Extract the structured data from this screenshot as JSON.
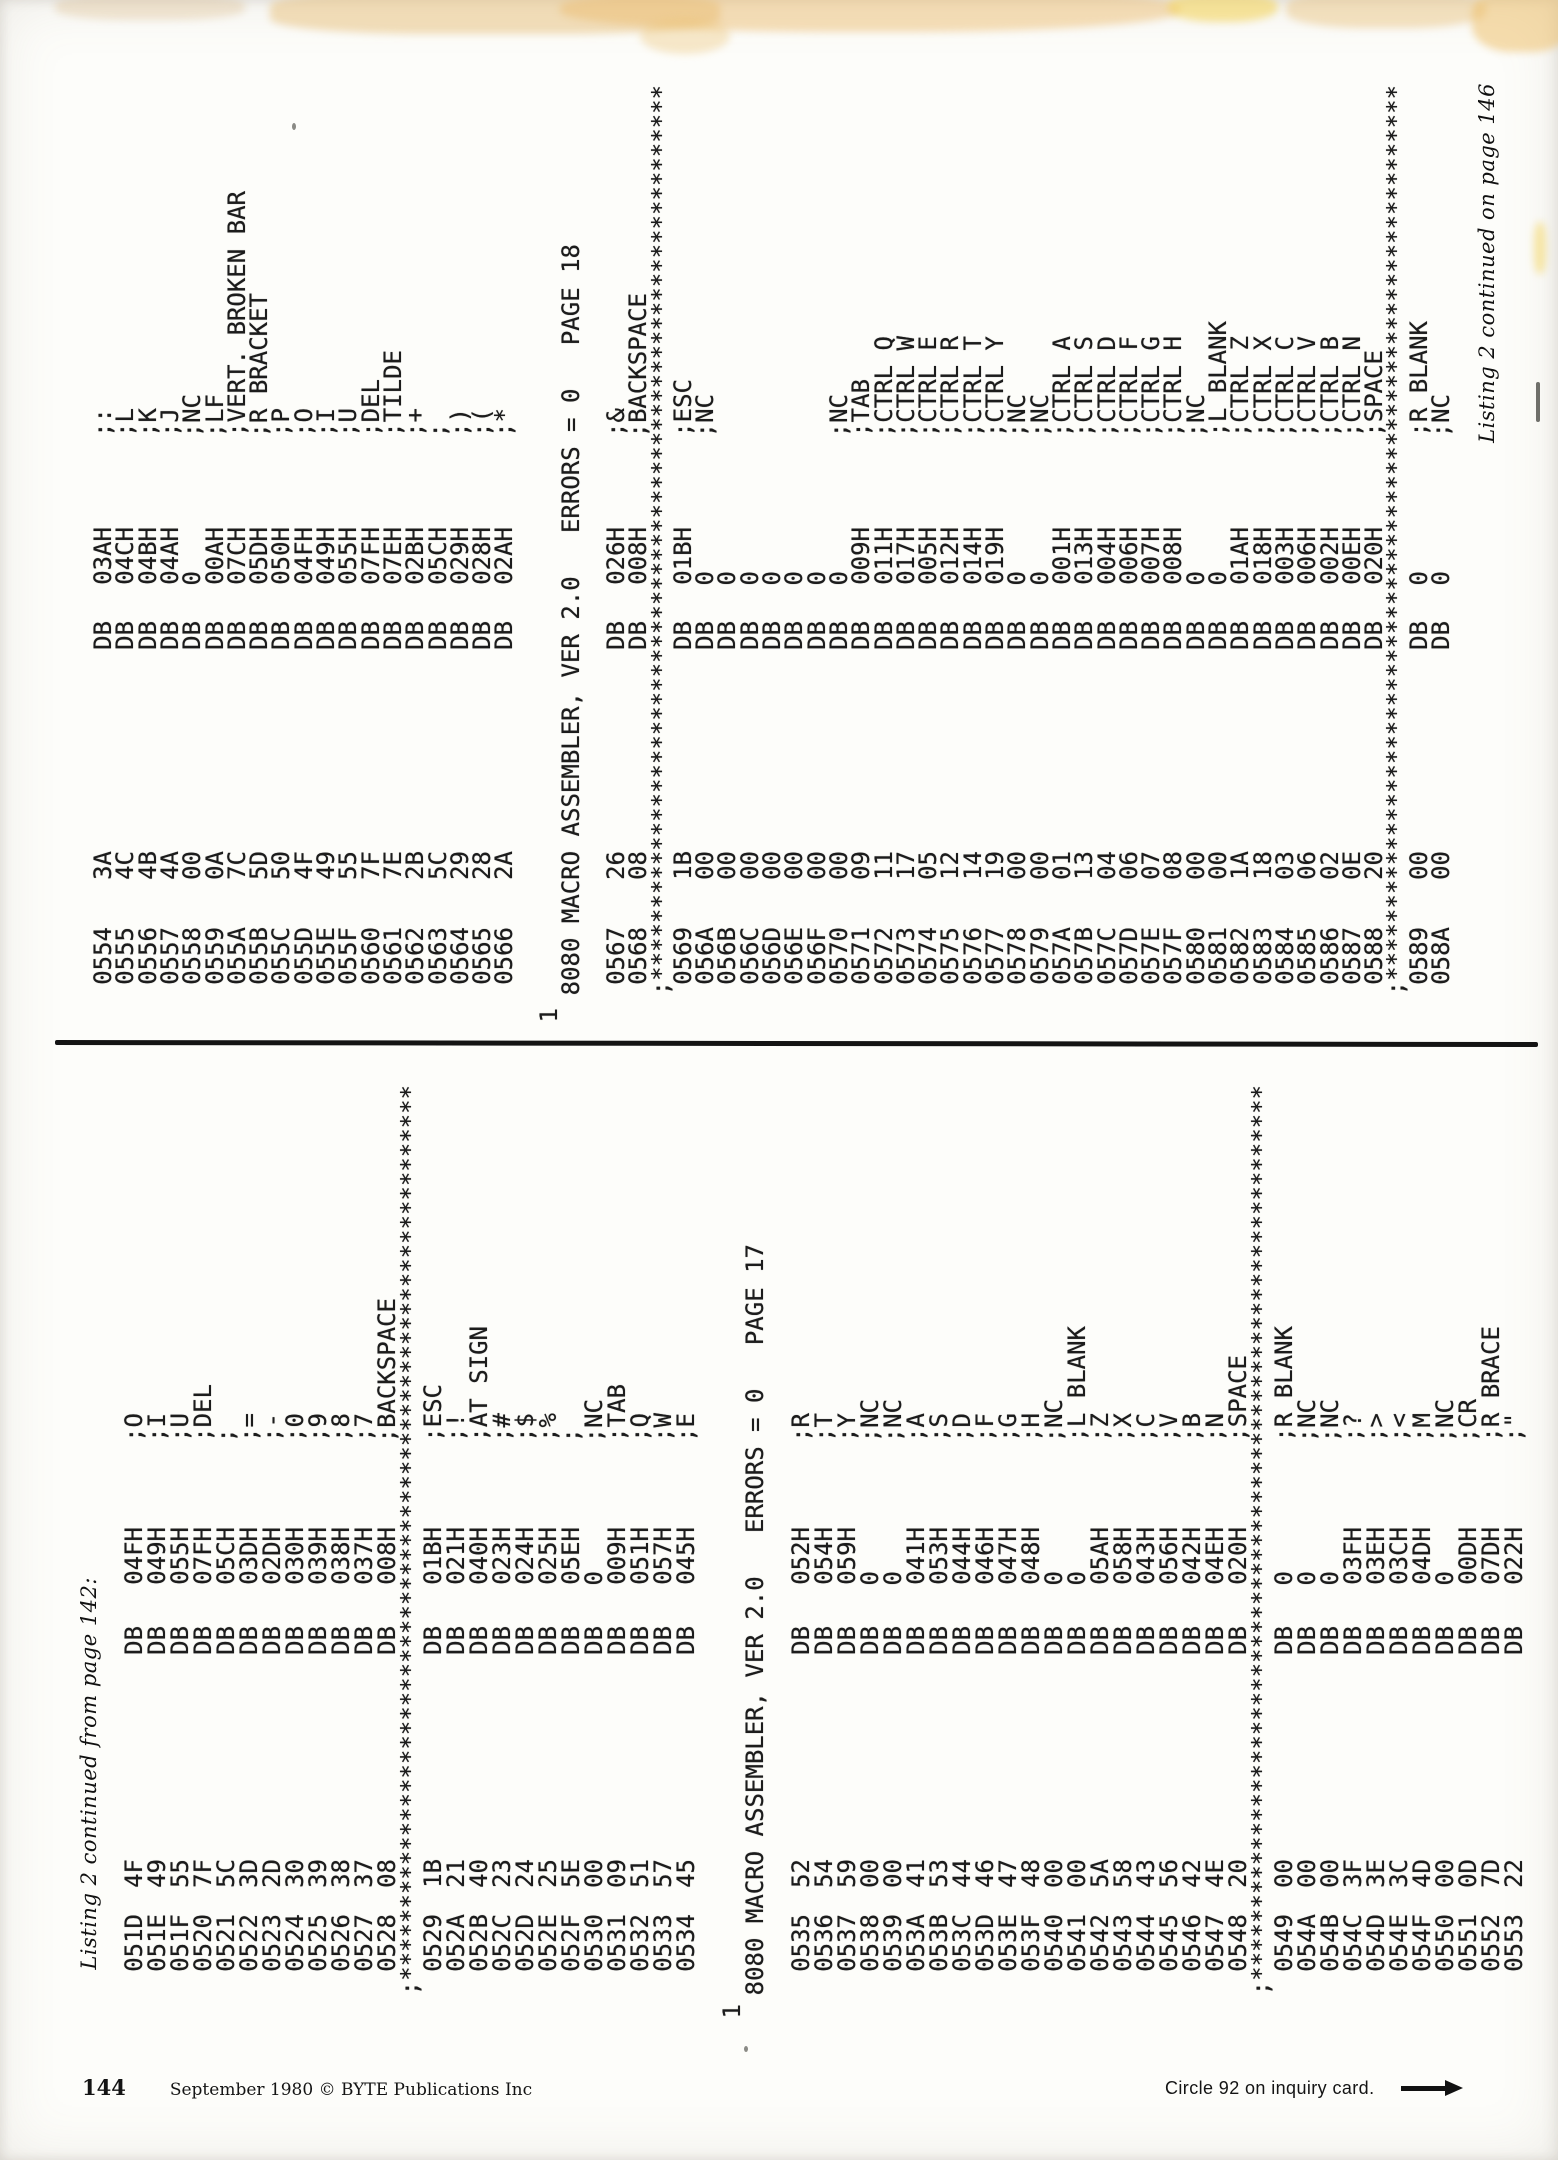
{
  "document": {
    "type": "magazine-listing-scan",
    "publication": "BYTE Publications Inc",
    "colors": {
      "paper": "#fdfdfa",
      "ink": "#1c1c1c",
      "smudge_tan": "#e8c07a",
      "smudge_yellow": "#f4d45e"
    }
  },
  "footer": {
    "page_number": "144",
    "imprint": "September 1980 © BYTE Publications Inc",
    "circle_note": "Circle 92 on inquiry card.",
    "arrow_icon": "right-arrow"
  },
  "stars_line": ";**************************************************************",
  "bands": [
    {
      "id": "p17",
      "caption": "Listing 2 continued from page 142:",
      "caption_position": "line-start",
      "form_feed_marker": "1",
      "header": "8080 MACRO ASSEMBLER, VER 2.0   ERRORS = 0   PAGE 17",
      "opcode": "DB",
      "columns": [
        {
          "t": "caption"
        },
        {
          "t": "gap"
        },
        {
          "t": "line",
          "a": "051D",
          "b": "4F",
          "o": "04FH",
          "c": ";O"
        },
        {
          "t": "line",
          "a": "051E",
          "b": "49",
          "o": "049H",
          "c": ";I"
        },
        {
          "t": "line",
          "a": "051F",
          "b": "55",
          "o": "055H",
          "c": ";U"
        },
        {
          "t": "line",
          "a": "0520",
          "b": "7F",
          "o": "07FH",
          "c": ";DEL"
        },
        {
          "t": "line",
          "a": "0521",
          "b": "5C",
          "o": "05CH",
          "c": ";"
        },
        {
          "t": "line",
          "a": "0522",
          "b": "3D",
          "o": "03DH",
          "c": ";="
        },
        {
          "t": "line",
          "a": "0523",
          "b": "2D",
          "o": "02DH",
          "c": ";-"
        },
        {
          "t": "line",
          "a": "0524",
          "b": "30",
          "o": "030H",
          "c": ";0"
        },
        {
          "t": "line",
          "a": "0525",
          "b": "39",
          "o": "039H",
          "c": ";9"
        },
        {
          "t": "line",
          "a": "0526",
          "b": "38",
          "o": "038H",
          "c": ";8"
        },
        {
          "t": "line",
          "a": "0527",
          "b": "37",
          "o": "037H",
          "c": ";7"
        },
        {
          "t": "line",
          "a": "0528",
          "b": "08",
          "o": "008H",
          "c": ";BACKSPACE"
        },
        {
          "t": "stars"
        },
        {
          "t": "line",
          "a": "0529",
          "b": "1B",
          "o": "01BH",
          "c": ";ESC"
        },
        {
          "t": "line",
          "a": "052A",
          "b": "21",
          "o": "021H",
          "c": ";!"
        },
        {
          "t": "line",
          "a": "052B",
          "b": "40",
          "o": "040H",
          "c": ";AT SIGN"
        },
        {
          "t": "line",
          "a": "052C",
          "b": "23",
          "o": "023H",
          "c": ";#"
        },
        {
          "t": "line",
          "a": "052D",
          "b": "24",
          "o": "024H",
          "c": ";$"
        },
        {
          "t": "line",
          "a": "052E",
          "b": "25",
          "o": "025H",
          "c": ";%"
        },
        {
          "t": "line",
          "a": "052F",
          "b": "5E",
          "o": "05EH",
          "c": ";"
        },
        {
          "t": "line",
          "a": "0530",
          "b": "00",
          "o": "0",
          "c": ";NC"
        },
        {
          "t": "line",
          "a": "0531",
          "b": "09",
          "o": "009H",
          "c": ";TAB"
        },
        {
          "t": "line",
          "a": "0532",
          "b": "51",
          "o": "051H",
          "c": ";Q"
        },
        {
          "t": "line",
          "a": "0533",
          "b": "57",
          "o": "057H",
          "c": ";W"
        },
        {
          "t": "line",
          "a": "0534",
          "b": "45",
          "o": "045H",
          "c": ";E"
        },
        {
          "t": "gap"
        },
        {
          "t": "ff"
        },
        {
          "t": "header"
        },
        {
          "t": "gap"
        },
        {
          "t": "line",
          "a": "0535",
          "b": "52",
          "o": "052H",
          "c": ";R"
        },
        {
          "t": "line",
          "a": "0536",
          "b": "54",
          "o": "054H",
          "c": ";T"
        },
        {
          "t": "line",
          "a": "0537",
          "b": "59",
          "o": "059H",
          "c": ";Y"
        },
        {
          "t": "line",
          "a": "0538",
          "b": "00",
          "o": "0",
          "c": ";NC"
        },
        {
          "t": "line",
          "a": "0539",
          "b": "00",
          "o": "0",
          "c": ";NC"
        },
        {
          "t": "line",
          "a": "053A",
          "b": "41",
          "o": "041H",
          "c": ";A"
        },
        {
          "t": "line",
          "a": "053B",
          "b": "53",
          "o": "053H",
          "c": ";S"
        },
        {
          "t": "line",
          "a": "053C",
          "b": "44",
          "o": "044H",
          "c": ";D"
        },
        {
          "t": "line",
          "a": "053D",
          "b": "46",
          "o": "046H",
          "c": ";F"
        },
        {
          "t": "line",
          "a": "053E",
          "b": "47",
          "o": "047H",
          "c": ";G"
        },
        {
          "t": "line",
          "a": "053F",
          "b": "48",
          "o": "048H",
          "c": ";H"
        },
        {
          "t": "line",
          "a": "0540",
          "b": "00",
          "o": "0",
          "c": ";NC"
        },
        {
          "t": "line",
          "a": "0541",
          "b": "00",
          "o": "0",
          "c": ";L BLANK"
        },
        {
          "t": "line",
          "a": "0542",
          "b": "5A",
          "o": "05AH",
          "c": ";Z"
        },
        {
          "t": "line",
          "a": "0543",
          "b": "58",
          "o": "058H",
          "c": ";X"
        },
        {
          "t": "line",
          "a": "0544",
          "b": "43",
          "o": "043H",
          "c": ";C"
        },
        {
          "t": "line",
          "a": "0545",
          "b": "56",
          "o": "056H",
          "c": ";V"
        },
        {
          "t": "line",
          "a": "0546",
          "b": "42",
          "o": "042H",
          "c": ";B"
        },
        {
          "t": "line",
          "a": "0547",
          "b": "4E",
          "o": "04EH",
          "c": ";N"
        },
        {
          "t": "line",
          "a": "0548",
          "b": "20",
          "o": "020H",
          "c": ";SPACE"
        },
        {
          "t": "stars"
        },
        {
          "t": "line",
          "a": "0549",
          "b": "00",
          "o": "0",
          "c": ";R BLANK"
        },
        {
          "t": "line",
          "a": "054A",
          "b": "00",
          "o": "0",
          "c": ";NC"
        },
        {
          "t": "line",
          "a": "054B",
          "b": "00",
          "o": "0",
          "c": ";NC"
        },
        {
          "t": "line",
          "a": "054C",
          "b": "3F",
          "o": "03FH",
          "c": ";?"
        },
        {
          "t": "line",
          "a": "054D",
          "b": "3E",
          "o": "03EH",
          "c": ";>"
        },
        {
          "t": "line",
          "a": "054E",
          "b": "3C",
          "o": "03CH",
          "c": ";<"
        },
        {
          "t": "line",
          "a": "054F",
          "b": "4D",
          "o": "04DH",
          "c": ";M"
        },
        {
          "t": "line",
          "a": "0550",
          "b": "00",
          "o": "0",
          "c": ";NC"
        },
        {
          "t": "line",
          "a": "0551",
          "b": "0D",
          "o": "00DH",
          "c": ";CR"
        },
        {
          "t": "line",
          "a": "0552",
          "b": "7D",
          "o": "07DH",
          "c": ";R BRACE"
        },
        {
          "t": "line",
          "a": "0553",
          "b": "22",
          "o": "022H",
          "c": ";\""
        }
      ]
    },
    {
      "id": "p18",
      "caption": "Listing 2 continued on page 146",
      "caption_position": "line-end",
      "form_feed_marker": "1",
      "header": "8080 MACRO ASSEMBLER, VER 2.0   ERRORS = 0   PAGE 18",
      "opcode": "DB",
      "columns": [
        {
          "t": "line",
          "a": "0554",
          "b": "3A",
          "o": "03AH",
          "c": ";:"
        },
        {
          "t": "line",
          "a": "0555",
          "b": "4C",
          "o": "04CH",
          "c": ";L"
        },
        {
          "t": "line",
          "a": "0556",
          "b": "4B",
          "o": "04BH",
          "c": ";K"
        },
        {
          "t": "line",
          "a": "0557",
          "b": "4A",
          "o": "04AH",
          "c": ";J"
        },
        {
          "t": "line",
          "a": "0558",
          "b": "00",
          "o": "0",
          "c": ";NC"
        },
        {
          "t": "line",
          "a": "0559",
          "b": "0A",
          "o": "00AH",
          "c": ";LF"
        },
        {
          "t": "line",
          "a": "055A",
          "b": "7C",
          "o": "07CH",
          "c": ";VERT. BROKEN BAR"
        },
        {
          "t": "line",
          "a": "055B",
          "b": "5D",
          "o": "05DH",
          "c": ";R BRACKET"
        },
        {
          "t": "line",
          "a": "055C",
          "b": "50",
          "o": "050H",
          "c": ";P"
        },
        {
          "t": "line",
          "a": "055D",
          "b": "4F",
          "o": "04FH",
          "c": ";O"
        },
        {
          "t": "line",
          "a": "055E",
          "b": "49",
          "o": "049H",
          "c": ";I"
        },
        {
          "t": "line",
          "a": "055F",
          "b": "55",
          "o": "055H",
          "c": ";U"
        },
        {
          "t": "line",
          "a": "0560",
          "b": "7F",
          "o": "07FH",
          "c": ";DEL"
        },
        {
          "t": "line",
          "a": "0561",
          "b": "7E",
          "o": "07EH",
          "c": ";TILDE"
        },
        {
          "t": "line",
          "a": "0562",
          "b": "2B",
          "o": "02BH",
          "c": ";+"
        },
        {
          "t": "line",
          "a": "0563",
          "b": "5C",
          "o": "05CH",
          "c": ";"
        },
        {
          "t": "line",
          "a": "0564",
          "b": "29",
          "o": "029H",
          "c": ";)"
        },
        {
          "t": "line",
          "a": "0565",
          "b": "28",
          "o": "028H",
          "c": ";("
        },
        {
          "t": "line",
          "a": "0566",
          "b": "2A",
          "o": "02AH",
          "c": ";*"
        },
        {
          "t": "gap"
        },
        {
          "t": "ff"
        },
        {
          "t": "header"
        },
        {
          "t": "gap"
        },
        {
          "t": "line",
          "a": "0567",
          "b": "26",
          "o": "026H",
          "c": ";&"
        },
        {
          "t": "line",
          "a": "0568",
          "b": "08",
          "o": "008H",
          "c": ";BACKSPACE"
        },
        {
          "t": "stars"
        },
        {
          "t": "line",
          "a": "0569",
          "b": "1B",
          "o": "01BH",
          "c": ";ESC"
        },
        {
          "t": "line",
          "a": "056A",
          "b": "00",
          "o": "0",
          "c": ";NC"
        },
        {
          "t": "line",
          "a": "056B",
          "b": "00",
          "o": "0",
          "c": ""
        },
        {
          "t": "line",
          "a": "056C",
          "b": "00",
          "o": "0",
          "c": ""
        },
        {
          "t": "line",
          "a": "056D",
          "b": "00",
          "o": "0",
          "c": ""
        },
        {
          "t": "line",
          "a": "056E",
          "b": "00",
          "o": "0",
          "c": ""
        },
        {
          "t": "line",
          "a": "056F",
          "b": "00",
          "o": "0",
          "c": ""
        },
        {
          "t": "line",
          "a": "0570",
          "b": "00",
          "o": "0",
          "c": ";NC"
        },
        {
          "t": "line",
          "a": "0571",
          "b": "09",
          "o": "009H",
          "c": ";TAB"
        },
        {
          "t": "line",
          "a": "0572",
          "b": "11",
          "o": "011H",
          "c": ";CTRL Q"
        },
        {
          "t": "line",
          "a": "0573",
          "b": "17",
          "o": "017H",
          "c": ";CTRL W"
        },
        {
          "t": "line",
          "a": "0574",
          "b": "05",
          "o": "005H",
          "c": ";CTRL E"
        },
        {
          "t": "line",
          "a": "0575",
          "b": "12",
          "o": "012H",
          "c": ";CTRL R"
        },
        {
          "t": "line",
          "a": "0576",
          "b": "14",
          "o": "014H",
          "c": ";CTRL T"
        },
        {
          "t": "line",
          "a": "0577",
          "b": "19",
          "o": "019H",
          "c": ";CTRL Y"
        },
        {
          "t": "line",
          "a": "0578",
          "b": "00",
          "o": "0",
          "c": ";NC"
        },
        {
          "t": "line",
          "a": "0579",
          "b": "00",
          "o": "0",
          "c": ";NC"
        },
        {
          "t": "line",
          "a": "057A",
          "b": "01",
          "o": "001H",
          "c": ";CTRL A"
        },
        {
          "t": "line",
          "a": "057B",
          "b": "13",
          "o": "013H",
          "c": ";CTRL S"
        },
        {
          "t": "line",
          "a": "057C",
          "b": "04",
          "o": "004H",
          "c": ";CTRL D"
        },
        {
          "t": "line",
          "a": "057D",
          "b": "06",
          "o": "006H",
          "c": ";CTRL F"
        },
        {
          "t": "line",
          "a": "057E",
          "b": "07",
          "o": "007H",
          "c": ";CTRL G"
        },
        {
          "t": "line",
          "a": "057F",
          "b": "08",
          "o": "008H",
          "c": ";CTRL H"
        },
        {
          "t": "line",
          "a": "0580",
          "b": "00",
          "o": "0",
          "c": ";NC"
        },
        {
          "t": "line",
          "a": "0581",
          "b": "00",
          "o": "0",
          "c": ";L BLANK"
        },
        {
          "t": "line",
          "a": "0582",
          "b": "1A",
          "o": "01AH",
          "c": ";CTRL Z"
        },
        {
          "t": "line",
          "a": "0583",
          "b": "18",
          "o": "018H",
          "c": ";CTRL X"
        },
        {
          "t": "line",
          "a": "0584",
          "b": "03",
          "o": "003H",
          "c": ";CTRL C"
        },
        {
          "t": "line",
          "a": "0585",
          "b": "06",
          "o": "006H",
          "c": ";CTRL V"
        },
        {
          "t": "line",
          "a": "0586",
          "b": "02",
          "o": "002H",
          "c": ";CTRL B"
        },
        {
          "t": "line",
          "a": "0587",
          "b": "0E",
          "o": "00EH",
          "c": ";CTRL N"
        },
        {
          "t": "line",
          "a": "0588",
          "b": "20",
          "o": "020H",
          "c": ";SPACE"
        },
        {
          "t": "stars"
        },
        {
          "t": "line",
          "a": "0589",
          "b": "00",
          "o": "0",
          "c": ";R BLANK"
        },
        {
          "t": "line",
          "a": "058A",
          "b": "00",
          "o": "0",
          "c": ";NC"
        },
        {
          "t": "gap"
        },
        {
          "t": "caption"
        }
      ]
    }
  ]
}
